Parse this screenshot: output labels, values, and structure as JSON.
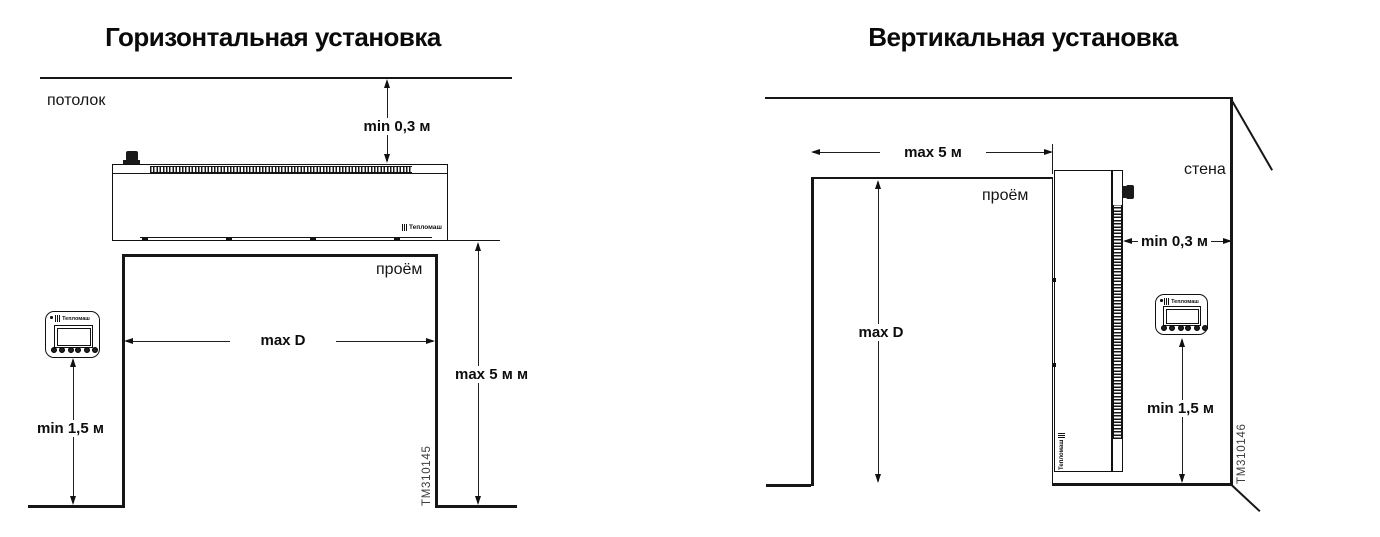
{
  "page": {
    "background": "#ffffff",
    "line_color": "#161616",
    "drawing_number_color": "#3d3d3d"
  },
  "left_diagram": {
    "title": "Горизонтальная установка",
    "ceiling_label": "потолок",
    "opening_label": "проём",
    "dims": {
      "ceiling_clearance": "min 0,3 м",
      "opening_width": "max D",
      "opening_height": "max 5 м м",
      "controller_height": "min 1,5 м"
    },
    "drawing_number": "TM310145",
    "unit_brand": "Тепломаш",
    "controller_brand": "Тепломаш"
  },
  "right_diagram": {
    "title": "Вертикальная установка",
    "wall_label": "стена",
    "opening_label": "проём",
    "dims": {
      "opening_width": "max 5 м",
      "wall_clearance": "min 0,3 м",
      "opening_height": "max D",
      "controller_height": "min 1,5 м"
    },
    "drawing_number": "TM310146",
    "unit_brand": "Тепломаш",
    "controller_brand": "Тепломаш"
  }
}
